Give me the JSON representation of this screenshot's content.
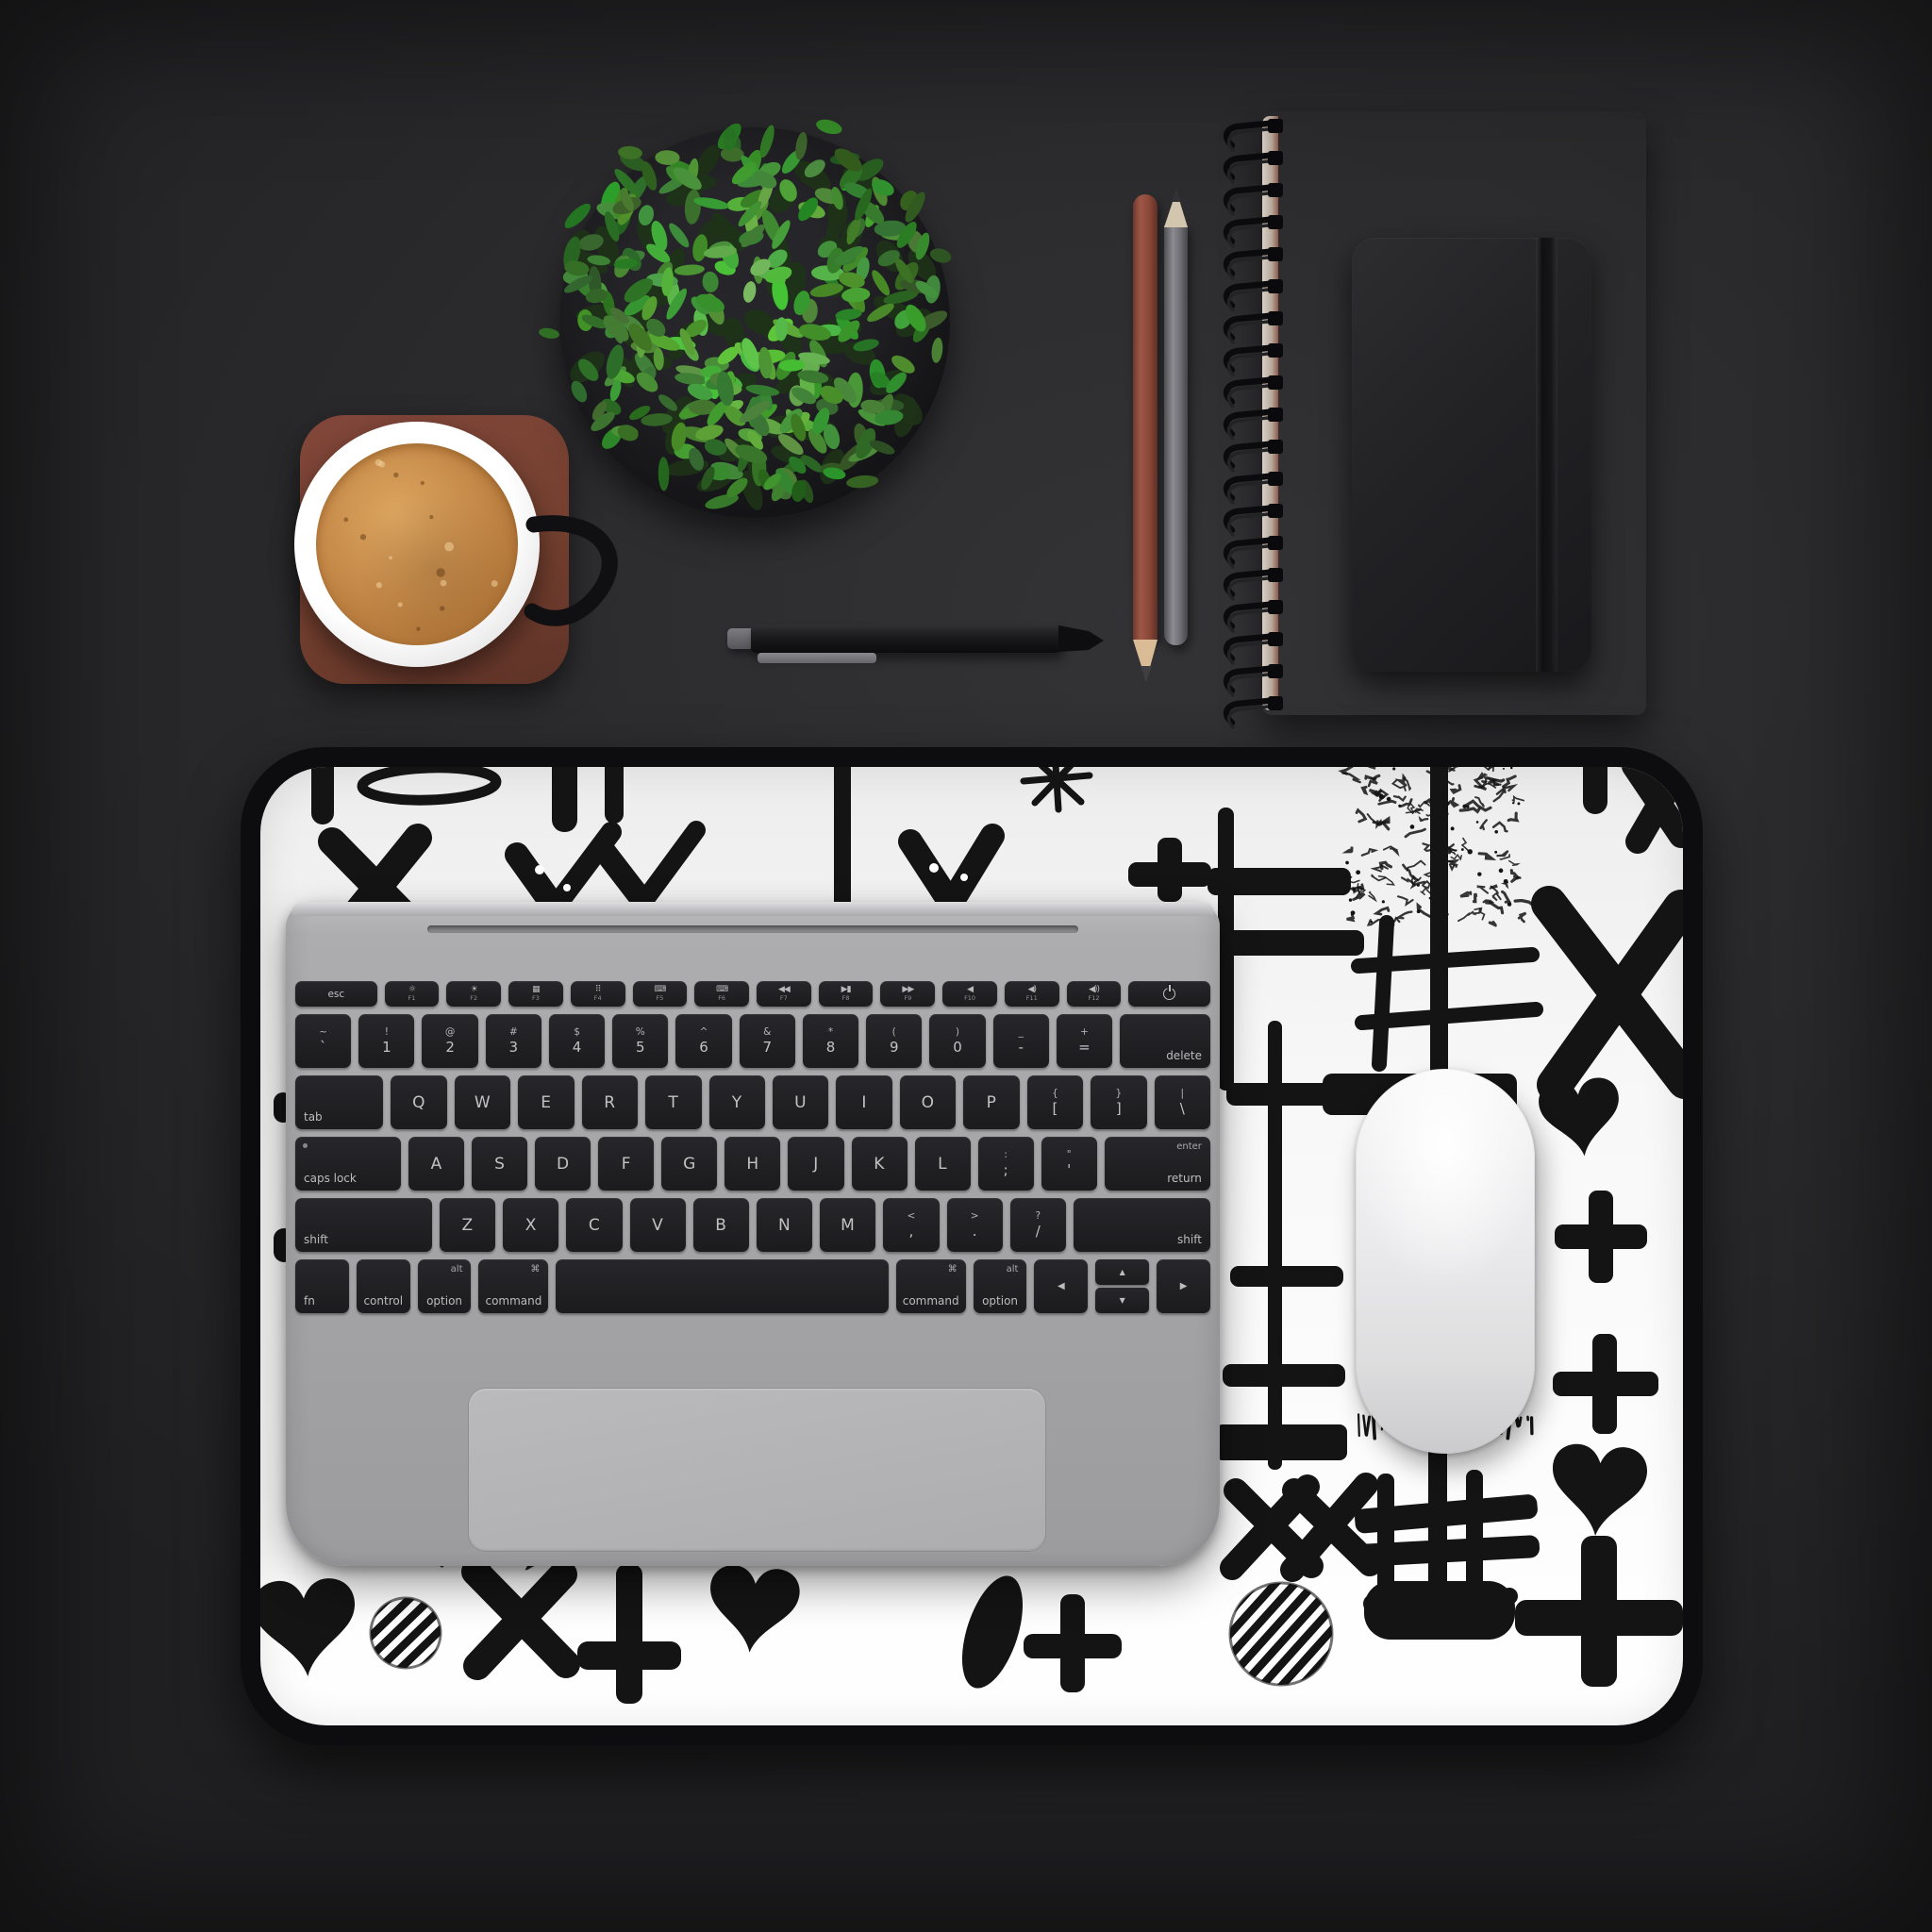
{
  "scene": {
    "type": "desk-flatlay-photo",
    "background_color": "#2a2a2c"
  },
  "mat": {
    "base_color": "#f7f7f7",
    "edge_color": "#0d0d0f",
    "pattern_color": "#141414",
    "pattern_symbols": [
      "heart",
      "x-mark",
      "double-x",
      "plus",
      "striped-circle",
      "hash-grid",
      "ladder-lines",
      "brush-stroke",
      "drip-line",
      "oval-outline",
      "check-marks",
      "starburst",
      "scribble-patch"
    ]
  },
  "laptop": {
    "body_color": "#a6a6a8",
    "key_color": "#1e1e21",
    "key_text_color": "#c2c2c5",
    "trackpad_color": "#b3b3b5",
    "keyboard": {
      "function_row": [
        {
          "k": "esc",
          "label": "esc",
          "grow": 1.5
        },
        {
          "k": "fn",
          "icon": "☼",
          "label": "F1"
        },
        {
          "k": "fn",
          "icon": "☀",
          "label": "F2"
        },
        {
          "k": "fn",
          "icon": "▦",
          "label": "F3"
        },
        {
          "k": "fn",
          "icon": "⠿",
          "label": "F4"
        },
        {
          "k": "fn",
          "icon": "⌨",
          "label": "F5"
        },
        {
          "k": "fn",
          "icon": "⌨",
          "label": "F6"
        },
        {
          "k": "fn",
          "icon": "◀◀",
          "label": "F7"
        },
        {
          "k": "fn",
          "icon": "▶▮",
          "label": "F8"
        },
        {
          "k": "fn",
          "icon": "▶▶",
          "label": "F9"
        },
        {
          "k": "fn",
          "icon": "◀",
          "label": "F10"
        },
        {
          "k": "fn",
          "icon": "◀)",
          "label": "F11"
        },
        {
          "k": "fn",
          "icon": "◀))",
          "label": "F12"
        },
        {
          "k": "power",
          "label": "power",
          "grow": 1.5
        }
      ],
      "rows": [
        [
          {
            "k": "s",
            "sup": "~",
            "sub": "`"
          },
          {
            "k": "s",
            "sup": "!",
            "sub": "1"
          },
          {
            "k": "s",
            "sup": "@",
            "sub": "2"
          },
          {
            "k": "s",
            "sup": "#",
            "sub": "3"
          },
          {
            "k": "s",
            "sup": "$",
            "sub": "4"
          },
          {
            "k": "s",
            "sup": "%",
            "sub": "5"
          },
          {
            "k": "s",
            "sup": "^",
            "sub": "6"
          },
          {
            "k": "s",
            "sup": "&",
            "sub": "7"
          },
          {
            "k": "s",
            "sup": "*",
            "sub": "8"
          },
          {
            "k": "s",
            "sup": "(",
            "sub": "9"
          },
          {
            "k": "s",
            "sup": ")",
            "sub": "0"
          },
          {
            "k": "s",
            "sup": "_",
            "sub": "-"
          },
          {
            "k": "s",
            "sup": "+",
            "sub": "="
          },
          {
            "k": "m",
            "label": "delete",
            "pos": "br",
            "grow": 1.62
          }
        ],
        [
          {
            "k": "m",
            "label": "tab",
            "pos": "bl",
            "grow": 1.57
          },
          {
            "k": "l",
            "label": "Q"
          },
          {
            "k": "l",
            "label": "W"
          },
          {
            "k": "l",
            "label": "E"
          },
          {
            "k": "l",
            "label": "R"
          },
          {
            "k": "l",
            "label": "T"
          },
          {
            "k": "l",
            "label": "Y"
          },
          {
            "k": "l",
            "label": "U"
          },
          {
            "k": "l",
            "label": "I"
          },
          {
            "k": "l",
            "label": "O"
          },
          {
            "k": "l",
            "label": "P"
          },
          {
            "k": "s",
            "sup": "{",
            "sub": "["
          },
          {
            "k": "s",
            "sup": "}",
            "sub": "]"
          },
          {
            "k": "s",
            "sup": "|",
            "sub": "\\"
          }
        ],
        [
          {
            "k": "m",
            "label": "caps lock",
            "pos": "bl",
            "dot": true,
            "grow": 1.9
          },
          {
            "k": "l",
            "label": "A"
          },
          {
            "k": "l",
            "label": "S"
          },
          {
            "k": "l",
            "label": "D"
          },
          {
            "k": "l",
            "label": "F"
          },
          {
            "k": "l",
            "label": "G"
          },
          {
            "k": "l",
            "label": "H"
          },
          {
            "k": "l",
            "label": "J"
          },
          {
            "k": "l",
            "label": "K"
          },
          {
            "k": "l",
            "label": "L"
          },
          {
            "k": "s",
            "sup": ":",
            "sub": ";"
          },
          {
            "k": "s",
            "sup": "\"",
            "sub": "'"
          },
          {
            "k": "ret",
            "sup": "enter",
            "label": "return",
            "grow": 1.9
          }
        ],
        [
          {
            "k": "m",
            "label": "shift",
            "pos": "bl",
            "grow": 2.45
          },
          {
            "k": "l",
            "label": "Z"
          },
          {
            "k": "l",
            "label": "X"
          },
          {
            "k": "l",
            "label": "C"
          },
          {
            "k": "l",
            "label": "V"
          },
          {
            "k": "l",
            "label": "B"
          },
          {
            "k": "l",
            "label": "N"
          },
          {
            "k": "l",
            "label": "M"
          },
          {
            "k": "s",
            "sup": "<",
            "sub": ","
          },
          {
            "k": "s",
            "sup": ">",
            "sub": "."
          },
          {
            "k": "s",
            "sup": "?",
            "sub": "/"
          },
          {
            "k": "m",
            "label": "shift",
            "pos": "br",
            "grow": 2.45
          }
        ],
        [
          {
            "k": "m",
            "label": "fn",
            "pos": "bl"
          },
          {
            "k": "m",
            "label": "control",
            "pos": "bc"
          },
          {
            "k": "m",
            "label": "option",
            "pos": "bc",
            "sup": "alt"
          },
          {
            "k": "m",
            "label": "command",
            "pos": "bc",
            "sup": "⌘",
            "grow": 1.3
          },
          {
            "k": "space",
            "grow": 6.2
          },
          {
            "k": "m",
            "label": "command",
            "pos": "bc",
            "sup": "⌘",
            "grow": 1.3
          },
          {
            "k": "m",
            "label": "option",
            "pos": "bc",
            "sup": "alt"
          },
          {
            "k": "arrow",
            "label": "◀"
          },
          {
            "k": "updown",
            "up": "▲",
            "down": "▼"
          },
          {
            "k": "arrow",
            "label": "▶"
          }
        ]
      ]
    }
  },
  "mouse": {
    "color": "#ededef"
  },
  "coffee": {
    "cup_color": "#ffffff",
    "coffee_color": "#bc8145",
    "handle_color": "#111113",
    "coaster_color": "#744033"
  },
  "plant": {
    "pot_color": "#19191c",
    "leaf_palette": [
      "#2f5e26",
      "#3f7a31",
      "#4c8f3a",
      "#58a244",
      "#6ab14e"
    ]
  },
  "pen": {
    "body_color": "#17171a",
    "clip_color": "#7d7d80"
  },
  "pencils": [
    {
      "name": "brown-pencil",
      "body_color": "#92503f",
      "tip_wood_color": "#dcc09c",
      "tip_lead_color": "#3a3a3c"
    },
    {
      "name": "gray-pencil",
      "body_color": "#77777b",
      "tip_wood_color": "#d6c9b2",
      "tip_lead_color": "#2b2b2d"
    }
  ],
  "notebooks": {
    "spiral": {
      "cover_color": "#9b5343",
      "coil_color": "#0c0c0e"
    },
    "black": {
      "cover_color": "#232326",
      "band_color": "#151518"
    }
  }
}
